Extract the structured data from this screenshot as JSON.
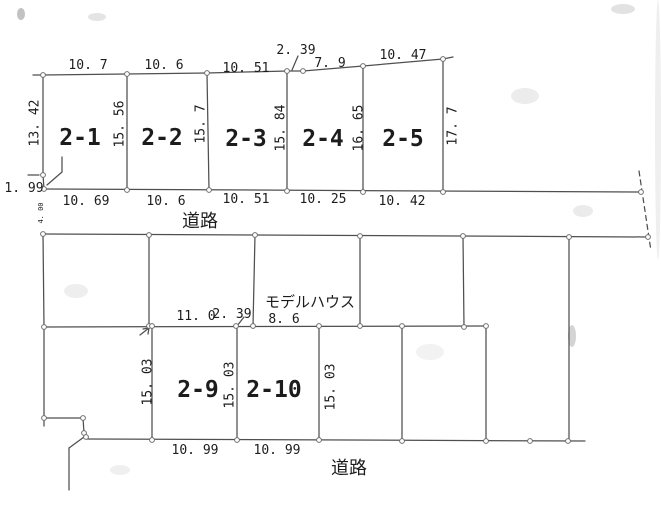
{
  "colors": {
    "line": "#4f4f4f",
    "line_dark": "#3c3c3c",
    "text": "#161616",
    "vertex_fill": "#ffffff",
    "vertex_stroke": "#6e6e6e",
    "background": "#ffffff"
  },
  "drawing": {
    "width": 661,
    "height": 505,
    "polylines": [
      {
        "name": "top-boundary-line",
        "points": [
          [
            33,
            75
          ],
          [
            43,
            75
          ],
          [
            127,
            74
          ],
          [
            207,
            73
          ],
          [
            287,
            71
          ],
          [
            303,
            71
          ],
          [
            363,
            66
          ],
          [
            443,
            59
          ],
          [
            453,
            57
          ]
        ]
      },
      {
        "name": "left-boundary-upper",
        "points": [
          [
            43,
            75
          ],
          [
            43,
            175
          ]
        ]
      },
      {
        "name": "left-boundary-jog-1-99",
        "points": [
          [
            43,
            175
          ],
          [
            44,
            189
          ]
        ]
      },
      {
        "name": "tick-left-1-99",
        "points": [
          [
            28,
            175
          ],
          [
            39,
            175
          ]
        ]
      },
      {
        "name": "leader-1-99",
        "points": [
          [
            62,
            157
          ],
          [
            62,
            172
          ],
          [
            47,
            185
          ]
        ]
      },
      {
        "name": "plot-divider-2-1-2-2",
        "points": [
          [
            127,
            74
          ],
          [
            127,
            190
          ]
        ]
      },
      {
        "name": "plot-divider-2-2-2-3",
        "points": [
          [
            207,
            73
          ],
          [
            209,
            190
          ]
        ]
      },
      {
        "name": "plot-divider-2-3-2-4",
        "points": [
          [
            287,
            71
          ],
          [
            287,
            191
          ]
        ]
      },
      {
        "name": "plot-divider-2-4-2-5",
        "points": [
          [
            363,
            66
          ],
          [
            363,
            192
          ]
        ]
      },
      {
        "name": "plot-right-boundary-2-5",
        "points": [
          [
            443,
            59
          ],
          [
            443,
            192
          ]
        ]
      },
      {
        "name": "leader-2-39-top",
        "points": [
          [
            298,
            56
          ],
          [
            292,
            70
          ]
        ]
      },
      {
        "name": "road-top-north-edge",
        "points": [
          [
            44,
            189
          ],
          [
            641,
            192
          ]
        ]
      },
      {
        "name": "road-top-south-edge",
        "points": [
          [
            43,
            234
          ],
          [
            648,
            237
          ]
        ]
      },
      {
        "name": "left-boundary-lower",
        "points": [
          [
            43,
            234
          ],
          [
            44,
            327
          ],
          [
            44,
            418
          ],
          [
            44,
            426
          ]
        ]
      },
      {
        "name": "mid-divider-a",
        "points": [
          [
            149,
            235
          ],
          [
            149,
            326
          ]
        ]
      },
      {
        "name": "mid-divider-b",
        "points": [
          [
            255,
            235
          ],
          [
            253,
            326
          ]
        ]
      },
      {
        "name": "mid-divider-c",
        "points": [
          [
            360,
            236
          ],
          [
            360,
            326
          ]
        ]
      },
      {
        "name": "mid-divider-d",
        "points": [
          [
            463,
            236
          ],
          [
            464,
            327
          ]
        ]
      },
      {
        "name": "east-long-divider",
        "points": [
          [
            569,
            237
          ],
          [
            569,
            440
          ]
        ]
      },
      {
        "name": "interior-line-mid",
        "points": [
          [
            44,
            327
          ],
          [
            486,
            326
          ]
        ]
      },
      {
        "name": "plot-left-boundary-2-9",
        "points": [
          [
            152,
            326
          ],
          [
            152,
            440
          ]
        ]
      },
      {
        "name": "plot-divider-2-9-2-10",
        "points": [
          [
            237,
            326
          ],
          [
            237,
            440
          ]
        ]
      },
      {
        "name": "plot-right-boundary-2-10",
        "points": [
          [
            319,
            326
          ],
          [
            319,
            440
          ]
        ]
      },
      {
        "name": "lower-divider-e",
        "points": [
          [
            402,
            326
          ],
          [
            402,
            441
          ]
        ]
      },
      {
        "name": "lower-divider-f",
        "points": [
          [
            486,
            326
          ],
          [
            486,
            441
          ]
        ]
      },
      {
        "name": "road-bottom-edge",
        "points": [
          [
            87,
            439
          ],
          [
            585,
            441
          ]
        ]
      },
      {
        "name": "southwest-jog-horizontal",
        "points": [
          [
            44,
            418
          ],
          [
            83,
            418
          ]
        ]
      },
      {
        "name": "southwest-jog-vertical",
        "points": [
          [
            83,
            418
          ],
          [
            84,
            433
          ],
          [
            86,
            437
          ],
          [
            87,
            439
          ]
        ]
      },
      {
        "name": "southwest-corner-diagonal",
        "points": [
          [
            84,
            437
          ],
          [
            69,
            448
          ]
        ]
      },
      {
        "name": "southwest-corner-vertical",
        "points": [
          [
            69,
            448
          ],
          [
            69,
            490
          ]
        ]
      },
      {
        "name": "leader-11-0-arrow",
        "points": [
          [
            140,
            335
          ],
          [
            149,
            328
          ]
        ]
      },
      {
        "name": "leader-11-0-arrowhead",
        "points": [
          [
            143,
            329
          ],
          [
            149,
            328
          ],
          [
            148,
            334
          ]
        ]
      },
      {
        "name": "leader-2-39-bottom",
        "points": [
          [
            244,
            317
          ],
          [
            237,
            326
          ]
        ]
      },
      {
        "name": "east-boundary-dashed",
        "points": [
          [
            639,
            171
          ],
          [
            651,
            251
          ]
        ],
        "dashed": true
      }
    ],
    "vertices": [
      [
        43,
        75
      ],
      [
        127,
        74
      ],
      [
        207,
        73
      ],
      [
        287,
        71
      ],
      [
        303,
        71
      ],
      [
        363,
        66
      ],
      [
        443,
        59
      ],
      [
        43,
        175
      ],
      [
        44,
        189
      ],
      [
        127,
        190
      ],
      [
        209,
        190
      ],
      [
        287,
        191
      ],
      [
        363,
        192
      ],
      [
        443,
        192
      ],
      [
        641,
        192
      ],
      [
        43,
        234
      ],
      [
        149,
        235
      ],
      [
        255,
        235
      ],
      [
        360,
        236
      ],
      [
        463,
        236
      ],
      [
        569,
        237
      ],
      [
        648,
        237
      ],
      [
        44,
        327
      ],
      [
        149,
        326
      ],
      [
        152,
        326
      ],
      [
        236,
        326
      ],
      [
        253,
        326
      ],
      [
        319,
        326
      ],
      [
        360,
        326
      ],
      [
        402,
        326
      ],
      [
        464,
        327
      ],
      [
        486,
        326
      ],
      [
        152,
        440
      ],
      [
        237,
        440
      ],
      [
        319,
        440
      ],
      [
        402,
        441
      ],
      [
        486,
        441
      ],
      [
        530,
        441
      ],
      [
        568,
        441
      ],
      [
        44,
        418
      ],
      [
        83,
        418
      ],
      [
        84,
        433
      ],
      [
        86,
        437
      ]
    ],
    "labels": [
      {
        "name": "dim-top-2-1",
        "text": "10. 7",
        "x": 88,
        "y": 69,
        "size": 13
      },
      {
        "name": "dim-top-2-2",
        "text": "10. 6",
        "x": 164,
        "y": 69,
        "size": 13
      },
      {
        "name": "dim-top-2-3",
        "text": "10. 51",
        "x": 246,
        "y": 72,
        "size": 13
      },
      {
        "name": "dim-top-jog",
        "text": "2. 39",
        "x": 296,
        "y": 54,
        "size": 13
      },
      {
        "name": "dim-top-2-4",
        "text": "7. 9",
        "x": 330,
        "y": 67,
        "size": 13
      },
      {
        "name": "dim-top-2-5",
        "text": "10. 47",
        "x": 403,
        "y": 59,
        "size": 13
      },
      {
        "name": "dim-left-west",
        "text": "13. 42",
        "x": 35,
        "y": 123,
        "size": 13,
        "rotate": -90
      },
      {
        "name": "dim-depth-2-1",
        "text": "15. 56",
        "x": 120,
        "y": 124,
        "size": 13,
        "rotate": -90
      },
      {
        "name": "dim-depth-2-2",
        "text": "15. 7",
        "x": 201,
        "y": 124,
        "size": 13,
        "rotate": -90
      },
      {
        "name": "dim-depth-2-3",
        "text": "15. 84",
        "x": 281,
        "y": 128,
        "size": 13,
        "rotate": -90
      },
      {
        "name": "dim-depth-2-4",
        "text": "16. 65",
        "x": 359,
        "y": 128,
        "size": 13,
        "rotate": -90
      },
      {
        "name": "dim-depth-2-5",
        "text": "17. 7",
        "x": 453,
        "y": 126,
        "size": 13,
        "rotate": -90
      },
      {
        "name": "dim-left-1-99",
        "text": "1. 99",
        "x": 24,
        "y": 192,
        "size": 13
      },
      {
        "name": "plot-label-2-1",
        "text": "2-1",
        "x": 80,
        "y": 145,
        "size": 23,
        "bold": true
      },
      {
        "name": "plot-label-2-2",
        "text": "2-2",
        "x": 162,
        "y": 145,
        "size": 23,
        "bold": true
      },
      {
        "name": "plot-label-2-3",
        "text": "2-3",
        "x": 246,
        "y": 146,
        "size": 23,
        "bold": true
      },
      {
        "name": "plot-label-2-4",
        "text": "2-4",
        "x": 323,
        "y": 146,
        "size": 23,
        "bold": true
      },
      {
        "name": "plot-label-2-5",
        "text": "2-5",
        "x": 403,
        "y": 146,
        "size": 23,
        "bold": true
      },
      {
        "name": "dim-bottom-2-1",
        "text": "10. 69",
        "x": 86,
        "y": 205,
        "size": 13
      },
      {
        "name": "dim-bottom-2-2",
        "text": "10. 6",
        "x": 166,
        "y": 205,
        "size": 13
      },
      {
        "name": "dim-bottom-2-3",
        "text": "10. 51",
        "x": 246,
        "y": 203,
        "size": 13
      },
      {
        "name": "dim-bottom-2-4",
        "text": "10. 25",
        "x": 323,
        "y": 203,
        "size": 13
      },
      {
        "name": "dim-bottom-2-5",
        "text": "10. 42",
        "x": 402,
        "y": 205,
        "size": 13
      },
      {
        "name": "road-label-top",
        "text": "道路",
        "x": 200,
        "y": 227,
        "size": 18,
        "cjk": true
      },
      {
        "name": "dim-road-width",
        "text": "4. 00",
        "x": 41,
        "y": 213,
        "size": 7,
        "rotate": -90
      },
      {
        "name": "model-house-label",
        "text": "モデルハウス",
        "x": 310,
        "y": 307,
        "size": 15,
        "cjk": true
      },
      {
        "name": "dim-mid-11-0",
        "text": "11. 0",
        "x": 196,
        "y": 320,
        "size": 13
      },
      {
        "name": "dim-mid-2-39",
        "text": "2. 39",
        "x": 232,
        "y": 318,
        "size": 13
      },
      {
        "name": "dim-mid-8-6",
        "text": "8. 6",
        "x": 284,
        "y": 323,
        "size": 13
      },
      {
        "name": "dim-depth-2-9-left",
        "text": "15. 03",
        "x": 148,
        "y": 382,
        "size": 13,
        "rotate": -90
      },
      {
        "name": "dim-depth-2-9-right",
        "text": "15. 03",
        "x": 230,
        "y": 385,
        "size": 13,
        "rotate": -90
      },
      {
        "name": "dim-depth-2-10-right",
        "text": "15. 03",
        "x": 331,
        "y": 387,
        "size": 13,
        "rotate": -90
      },
      {
        "name": "plot-label-2-9",
        "text": "2-9",
        "x": 198,
        "y": 397,
        "size": 23,
        "bold": true
      },
      {
        "name": "plot-label-2-10",
        "text": "2-10",
        "x": 274,
        "y": 397,
        "size": 23,
        "bold": true
      },
      {
        "name": "dim-bottom-2-9",
        "text": "10. 99",
        "x": 195,
        "y": 454,
        "size": 13
      },
      {
        "name": "dim-bottom-2-10",
        "text": "10. 99",
        "x": 277,
        "y": 454,
        "size": 13
      },
      {
        "name": "road-label-bottom",
        "text": "道路",
        "x": 349,
        "y": 474,
        "size": 18,
        "cjk": true
      }
    ],
    "smudges": [
      {
        "name": "scan-speck-topleft",
        "cx": 21,
        "cy": 14,
        "rx": 4,
        "ry": 6,
        "color": "#8f8f8f",
        "opacity": 0.55
      },
      {
        "name": "scan-smudge-1",
        "cx": 97,
        "cy": 17,
        "rx": 9,
        "ry": 4,
        "color": "#d9d9d9",
        "opacity": 0.7
      },
      {
        "name": "scan-smudge-2",
        "cx": 623,
        "cy": 9,
        "rx": 12,
        "ry": 5,
        "color": "#cfcfcf",
        "opacity": 0.6
      },
      {
        "name": "scan-smudge-3",
        "cx": 525,
        "cy": 96,
        "rx": 14,
        "ry": 8,
        "color": "#e4e4e4",
        "opacity": 0.7
      },
      {
        "name": "scan-smudge-4",
        "cx": 583,
        "cy": 211,
        "rx": 10,
        "ry": 6,
        "color": "#dedede",
        "opacity": 0.6
      },
      {
        "name": "scan-smudge-5",
        "cx": 76,
        "cy": 291,
        "rx": 12,
        "ry": 7,
        "color": "#e7e7e7",
        "opacity": 0.7
      },
      {
        "name": "scan-smudge-6",
        "cx": 430,
        "cy": 352,
        "rx": 14,
        "ry": 8,
        "color": "#e9e9e9",
        "opacity": 0.6
      },
      {
        "name": "scan-smudge-7",
        "cx": 120,
        "cy": 470,
        "rx": 10,
        "ry": 5,
        "color": "#e5e5e5",
        "opacity": 0.6
      },
      {
        "name": "scan-smudge-faint-text",
        "cx": 572,
        "cy": 336,
        "rx": 4,
        "ry": 11,
        "color": "#c9c9c9",
        "opacity": 0.8
      },
      {
        "name": "scan-edge-band-right",
        "cx": 658,
        "cy": 130,
        "rx": 3,
        "ry": 130,
        "color": "#dcdcdc",
        "opacity": 0.45
      }
    ]
  }
}
